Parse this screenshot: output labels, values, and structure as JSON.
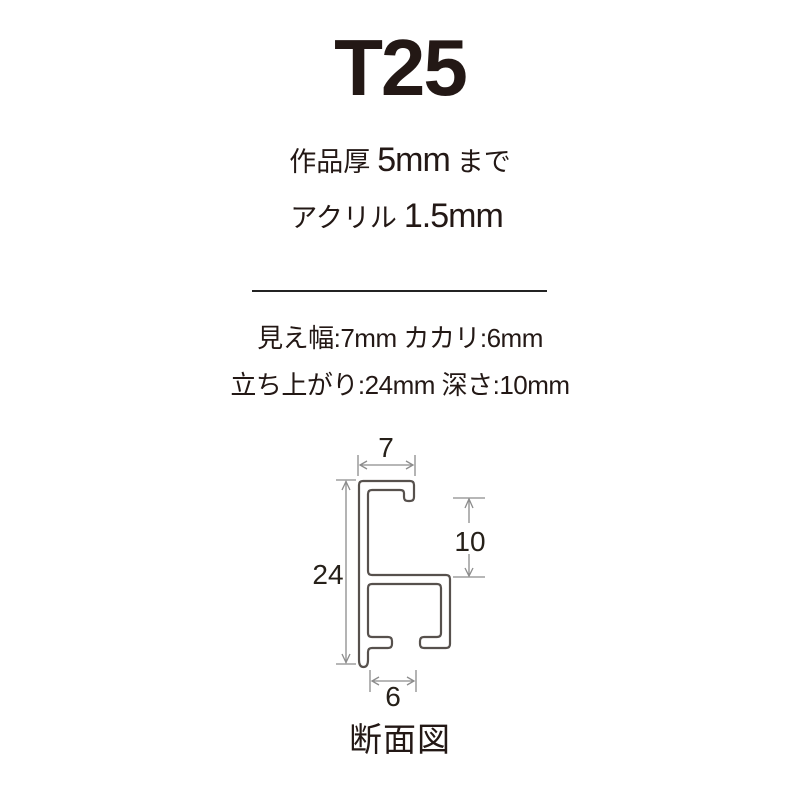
{
  "colors": {
    "background": "#ffffff",
    "text": "#231815",
    "profile_stroke": "#57514d",
    "dimension_lines": "#8c8c8c",
    "divider": "#232323"
  },
  "header": {
    "title": "T25"
  },
  "specs": {
    "work_thickness_label": "作品厚",
    "work_thickness_value": "5mm",
    "work_thickness_suffix": "まで",
    "acrylic_label": "アクリル",
    "acrylic_value": "1.5mm"
  },
  "details": {
    "line1": "見え幅:7mm カカリ:6mm",
    "line2": "立ち上がり:24mm 深さ:10mm"
  },
  "diagram": {
    "caption": "断面図",
    "dim_top_width": "7",
    "dim_height": "24",
    "dim_inner_depth": "10",
    "dim_bottom_width": "6"
  }
}
